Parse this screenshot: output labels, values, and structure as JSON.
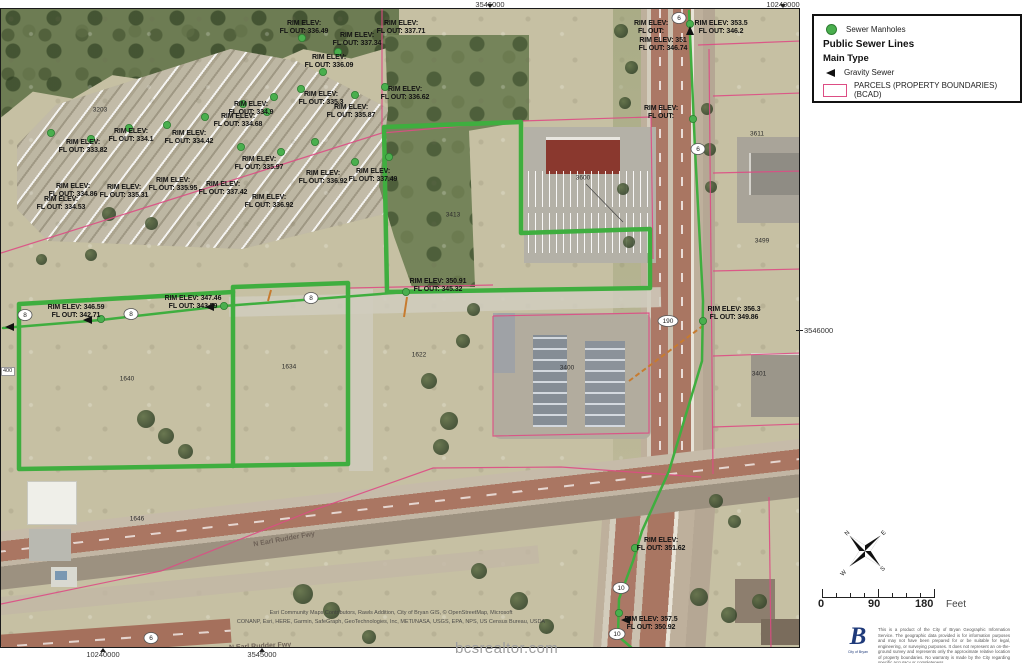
{
  "page": {
    "watermark": "bcsrealtor.com"
  },
  "colors": {
    "sewer_green": "#3fae3f",
    "manhole_fill": "#4aaf4e",
    "manhole_edge": "#2e7d32",
    "parcel_pink": "#dd4d84",
    "lateral_orange": "#c77b2f",
    "label_black": "#141414"
  },
  "legend": {
    "items": [
      {
        "type": "dot",
        "label": "Sewer Manholes"
      },
      {
        "type": "title",
        "label": "Public Sewer Lines"
      },
      {
        "type": "sub",
        "label": "Main Type"
      },
      {
        "type": "arrow",
        "label": "Gravity Sewer"
      },
      {
        "type": "swatch",
        "label": "PARCELS (PROPERTY BOUNDARIES) (BCAD)"
      }
    ]
  },
  "grid": {
    "top": [
      {
        "x": 490,
        "label": "3546000"
      },
      {
        "x": 783,
        "label": "10240000"
      }
    ],
    "bottom": [
      {
        "x": 103,
        "label": "10240000"
      },
      {
        "x": 262,
        "label": "3545000"
      }
    ],
    "right": {
      "label": "3546000"
    },
    "left": {
      "label": "400"
    }
  },
  "scalebar": {
    "start": "0",
    "middle": "90",
    "end": "180",
    "unit": "Feet"
  },
  "compass": {
    "n": "N",
    "e": "E",
    "s": "S",
    "w": "W"
  },
  "logo": {
    "letter": "B",
    "caption": "City of Bryan"
  },
  "disclaimer": "This is a product of the City of Bryan Geographic Information Service. The geographic data provided is for information purposes and may not have been prepared for or be suitable for legal, engineering, or surveying purposes. It does not represent an on-the-ground survey and represents only the approximate relative location of property boundaries. No warranty is made by the City regarding specific accuracy or completeness.",
  "attribution": {
    "line1": "Esri Community Maps Contributors, Rawls Addition, City of Bryan GIS, © OpenStreetMap, Microsoft",
    "line2": "CONANP, Esri, HERE, Garmin, SafeGraph, GeoTechnologies, Inc, METI/NASA, USGS, EPA, NPS, US Census Bureau, USDA"
  },
  "map": {
    "elevation_labels": [
      {
        "x": 303,
        "y": 11,
        "lines": [
          "RIM ELEV:",
          "FL OUT: 336.49"
        ]
      },
      {
        "x": 400,
        "y": 11,
        "lines": [
          "RIM ELEV:",
          "FL OUT: 337.71"
        ]
      },
      {
        "x": 356,
        "y": 23,
        "lines": [
          "RIM ELEV:",
          "FL OUT: 337.34"
        ]
      },
      {
        "x": 328,
        "y": 45,
        "lines": [
          "RIM ELEV:",
          "FL OUT: 336.09"
        ]
      },
      {
        "x": 404,
        "y": 77,
        "lines": [
          "RIM ELEV:",
          "FL OUT: 336.62"
        ]
      },
      {
        "x": 320,
        "y": 82,
        "lines": [
          "RIM ELEV:",
          "FL OUT: 335.3"
        ]
      },
      {
        "x": 350,
        "y": 95,
        "lines": [
          "RIM ELEV:",
          "FL OUT: 335.87"
        ]
      },
      {
        "x": 250,
        "y": 92,
        "lines": [
          "RIM ELEV:",
          "FL OUT: 334.9"
        ]
      },
      {
        "x": 237,
        "y": 104,
        "lines": [
          "RIM ELEV:",
          "FL OUT: 334.68"
        ]
      },
      {
        "x": 130,
        "y": 119,
        "lines": [
          "RIM ELEV:",
          "FL OUT: 334.1"
        ]
      },
      {
        "x": 188,
        "y": 121,
        "lines": [
          "RIM ELEV:",
          "FL OUT: 334.42"
        ]
      },
      {
        "x": 82,
        "y": 130,
        "lines": [
          "RIM ELEV:",
          "FL OUT: 333.82"
        ]
      },
      {
        "x": 258,
        "y": 147,
        "lines": [
          "RIM ELEV:",
          "FL OUT: 335.97"
        ]
      },
      {
        "x": 172,
        "y": 168,
        "lines": [
          "RIM ELEV:",
          "FL OUT: 335.95"
        ]
      },
      {
        "x": 222,
        "y": 172,
        "lines": [
          "RIM ELEV:",
          "FL OUT: 337.42"
        ]
      },
      {
        "x": 123,
        "y": 175,
        "lines": [
          "RIM ELEV:",
          "FL OUT: 335.31"
        ]
      },
      {
        "x": 72,
        "y": 174,
        "lines": [
          "RIM ELEV:",
          "FL OUT: 334.86"
        ]
      },
      {
        "x": 60,
        "y": 187,
        "lines": [
          "RIM ELEV:",
          "FL OUT: 334.53"
        ]
      },
      {
        "x": 268,
        "y": 185,
        "lines": [
          "RIM ELEV:",
          "FL OUT: 336.92"
        ]
      },
      {
        "x": 322,
        "y": 161,
        "lines": [
          "RIM ELEV:",
          "FL OUT: 336.92"
        ]
      },
      {
        "x": 372,
        "y": 159,
        "lines": [
          "RIM ELEV:",
          "FL OUT: 337.49"
        ]
      },
      {
        "x": 75,
        "y": 295,
        "lines": [
          "RIM ELEV: 346.59",
          "FL OUT: 342.71"
        ]
      },
      {
        "x": 192,
        "y": 286,
        "lines": [
          "RIM ELEV: 347.46",
          "FL OUT: 343.59"
        ]
      },
      {
        "x": 437,
        "y": 269,
        "lines": [
          "RIM ELEV: 350.91",
          "FL OUT: 345.32"
        ]
      },
      {
        "x": 733,
        "y": 297,
        "lines": [
          "RIM ELEV: 356.3",
          "FL OUT: 349.86"
        ]
      },
      {
        "x": 660,
        "y": 96,
        "lines": [
          "RIM ELEV:",
          "FL OUT:"
        ]
      },
      {
        "x": 650,
        "y": 11,
        "lines": [
          "RIM ELEV:",
          "FL OUT:"
        ]
      },
      {
        "x": 720,
        "y": 11,
        "lines": [
          "RIM ELEV: 353.5",
          "FL OUT: 346.2"
        ]
      },
      {
        "x": 662,
        "y": 28,
        "lines": [
          "RIM ELEV: 351",
          "FL OUT: 346.74"
        ]
      },
      {
        "x": 660,
        "y": 528,
        "lines": [
          "RIM ELEV:",
          "FL OUT: 351.62"
        ]
      },
      {
        "x": 650,
        "y": 607,
        "lines": [
          "RIM ELEV: 357.5",
          "FL OUT: 350.92"
        ]
      }
    ],
    "parcel_numbers": [
      {
        "x": 99,
        "y": 101,
        "text": "3203"
      },
      {
        "x": 452,
        "y": 206,
        "text": "3413"
      },
      {
        "x": 582,
        "y": 169,
        "text": "3600"
      },
      {
        "x": 756,
        "y": 125,
        "text": "3611"
      },
      {
        "x": 761,
        "y": 232,
        "text": "3499"
      },
      {
        "x": 566,
        "y": 359,
        "text": "3400"
      },
      {
        "x": 758,
        "y": 365,
        "text": "3401"
      },
      {
        "x": 126,
        "y": 370,
        "text": "1640"
      },
      {
        "x": 288,
        "y": 358,
        "text": "1634"
      },
      {
        "x": 418,
        "y": 346,
        "text": "1622"
      },
      {
        "x": 136,
        "y": 510,
        "text": "1646"
      }
    ],
    "road_labels": [
      {
        "x": 252,
        "y": 527,
        "text": "N Earl Rudder Fwy",
        "rotate": -10
      },
      {
        "x": 228,
        "y": 634,
        "text": "N Earl Rudder Fwy",
        "rotate": -3
      }
    ],
    "shields": [
      {
        "x": 24,
        "y": 306,
        "text": "8",
        "rx": 7
      },
      {
        "x": 130,
        "y": 305,
        "text": "8",
        "rx": 7
      },
      {
        "x": 310,
        "y": 289,
        "text": "8",
        "rx": 7
      },
      {
        "x": 678,
        "y": 9,
        "text": "6",
        "rx": 7
      },
      {
        "x": 697,
        "y": 140,
        "text": "6",
        "rx": 7
      },
      {
        "x": 667,
        "y": 312,
        "text": "190",
        "rx": 10
      },
      {
        "x": 620,
        "y": 579,
        "text": "10",
        "rx": 8
      },
      {
        "x": 616,
        "y": 625,
        "text": "10",
        "rx": 8
      },
      {
        "x": 150,
        "y": 629,
        "text": "6",
        "rx": 7
      }
    ],
    "manholes": [
      [
        50,
        124
      ],
      [
        90,
        130
      ],
      [
        128,
        119
      ],
      [
        166,
        116
      ],
      [
        204,
        108
      ],
      [
        242,
        95
      ],
      [
        273,
        88
      ],
      [
        300,
        80
      ],
      [
        322,
        63
      ],
      [
        337,
        43
      ],
      [
        301,
        29
      ],
      [
        266,
        103
      ],
      [
        354,
        86
      ],
      [
        384,
        78
      ],
      [
        240,
        138
      ],
      [
        280,
        143
      ],
      [
        314,
        133
      ],
      [
        354,
        153
      ],
      [
        388,
        148
      ],
      [
        100,
        310
      ],
      [
        223,
        297
      ],
      [
        405,
        283
      ],
      [
        689,
        15
      ],
      [
        692,
        110
      ],
      [
        702,
        312
      ],
      [
        634,
        539
      ],
      [
        618,
        604
      ]
    ],
    "flow_arrows": [
      {
        "x": 8,
        "y": 318,
        "dir": "left"
      },
      {
        "x": 86,
        "y": 311,
        "dir": "left"
      },
      {
        "x": 208,
        "y": 298,
        "dir": "left"
      },
      {
        "x": 689,
        "y": 22,
        "dir": "up"
      },
      {
        "x": 624,
        "y": 611,
        "dir": "left"
      }
    ],
    "sewer_lines": [
      {
        "points": [
          [
            18,
            295
          ],
          [
            232,
            283
          ],
          [
            232,
            278
          ],
          [
            347,
            274
          ],
          [
            347,
            455
          ],
          [
            18,
            460
          ]
        ],
        "width": 4.5,
        "closed": true
      },
      {
        "points": [
          [
            232,
            283
          ],
          [
            232,
            457
          ]
        ],
        "width": 4.5,
        "closed": false
      },
      {
        "points": [
          [
            383,
            118
          ],
          [
            520,
            113
          ],
          [
            520,
            224
          ],
          [
            649,
            220
          ],
          [
            649,
            279
          ],
          [
            386,
            283
          ]
        ],
        "width": 4.5,
        "closed": true
      },
      {
        "points": [
          [
            2,
            319
          ],
          [
            100,
            311
          ],
          [
            223,
            297
          ],
          [
            405,
            283
          ]
        ],
        "width": 2.5,
        "closed": false
      },
      {
        "points": [
          [
            688,
            2
          ],
          [
            694,
            140
          ],
          [
            702,
            292
          ],
          [
            701,
            352
          ],
          [
            668,
            462
          ],
          [
            641,
            522
          ],
          [
            632,
            552
          ],
          [
            618,
            590
          ],
          [
            617,
            627
          ],
          [
            632,
            640
          ]
        ],
        "width": 2.5,
        "closed": false
      }
    ],
    "parcel_lines": [
      {
        "points": [
          [
            381,
            0
          ],
          [
            381,
            124
          ],
          [
            0,
            244
          ]
        ]
      },
      {
        "points": [
          [
            381,
            124
          ],
          [
            520,
            112
          ],
          [
            650,
            108
          ]
        ]
      },
      {
        "points": [
          [
            650,
            108
          ],
          [
            652,
            250
          ]
        ]
      },
      {
        "points": [
          [
            697,
            36
          ],
          [
            800,
            32
          ]
        ]
      },
      {
        "points": [
          [
            708,
            40
          ],
          [
            712,
            465
          ]
        ]
      },
      {
        "points": [
          [
            712,
            87
          ],
          [
            800,
            84
          ]
        ]
      },
      {
        "points": [
          [
            712,
            164
          ],
          [
            800,
            162
          ]
        ]
      },
      {
        "points": [
          [
            712,
            262
          ],
          [
            800,
            260
          ]
        ]
      },
      {
        "points": [
          [
            712,
            347
          ],
          [
            800,
            344
          ]
        ]
      },
      {
        "points": [
          [
            712,
            418
          ],
          [
            800,
            415
          ]
        ]
      },
      {
        "points": [
          [
            492,
            307
          ],
          [
            648,
            304
          ],
          [
            648,
            424
          ],
          [
            492,
            427
          ],
          [
            492,
            307
          ]
        ]
      },
      {
        "points": [
          [
            349,
            279
          ],
          [
            492,
            276
          ]
        ]
      },
      {
        "points": [
          [
            0,
            595
          ],
          [
            160,
            562
          ],
          [
            310,
            502
          ],
          [
            432,
            459
          ],
          [
            560,
            458
          ],
          [
            700,
            468
          ]
        ]
      },
      {
        "points": [
          [
            768,
            488
          ],
          [
            770,
            640
          ]
        ]
      }
    ],
    "laterals": {
      "dashed": [
        [
          628,
          372
        ],
        [
          703,
          316
        ]
      ],
      "ticks": [
        [
          [
            406,
            288
          ],
          [
            403,
            308
          ]
        ],
        [
          [
            270,
            281
          ],
          [
            267,
            292
          ]
        ]
      ],
      "leaders": [
        [
          [
            585,
            175
          ],
          [
            622,
            213
          ]
        ]
      ]
    }
  }
}
